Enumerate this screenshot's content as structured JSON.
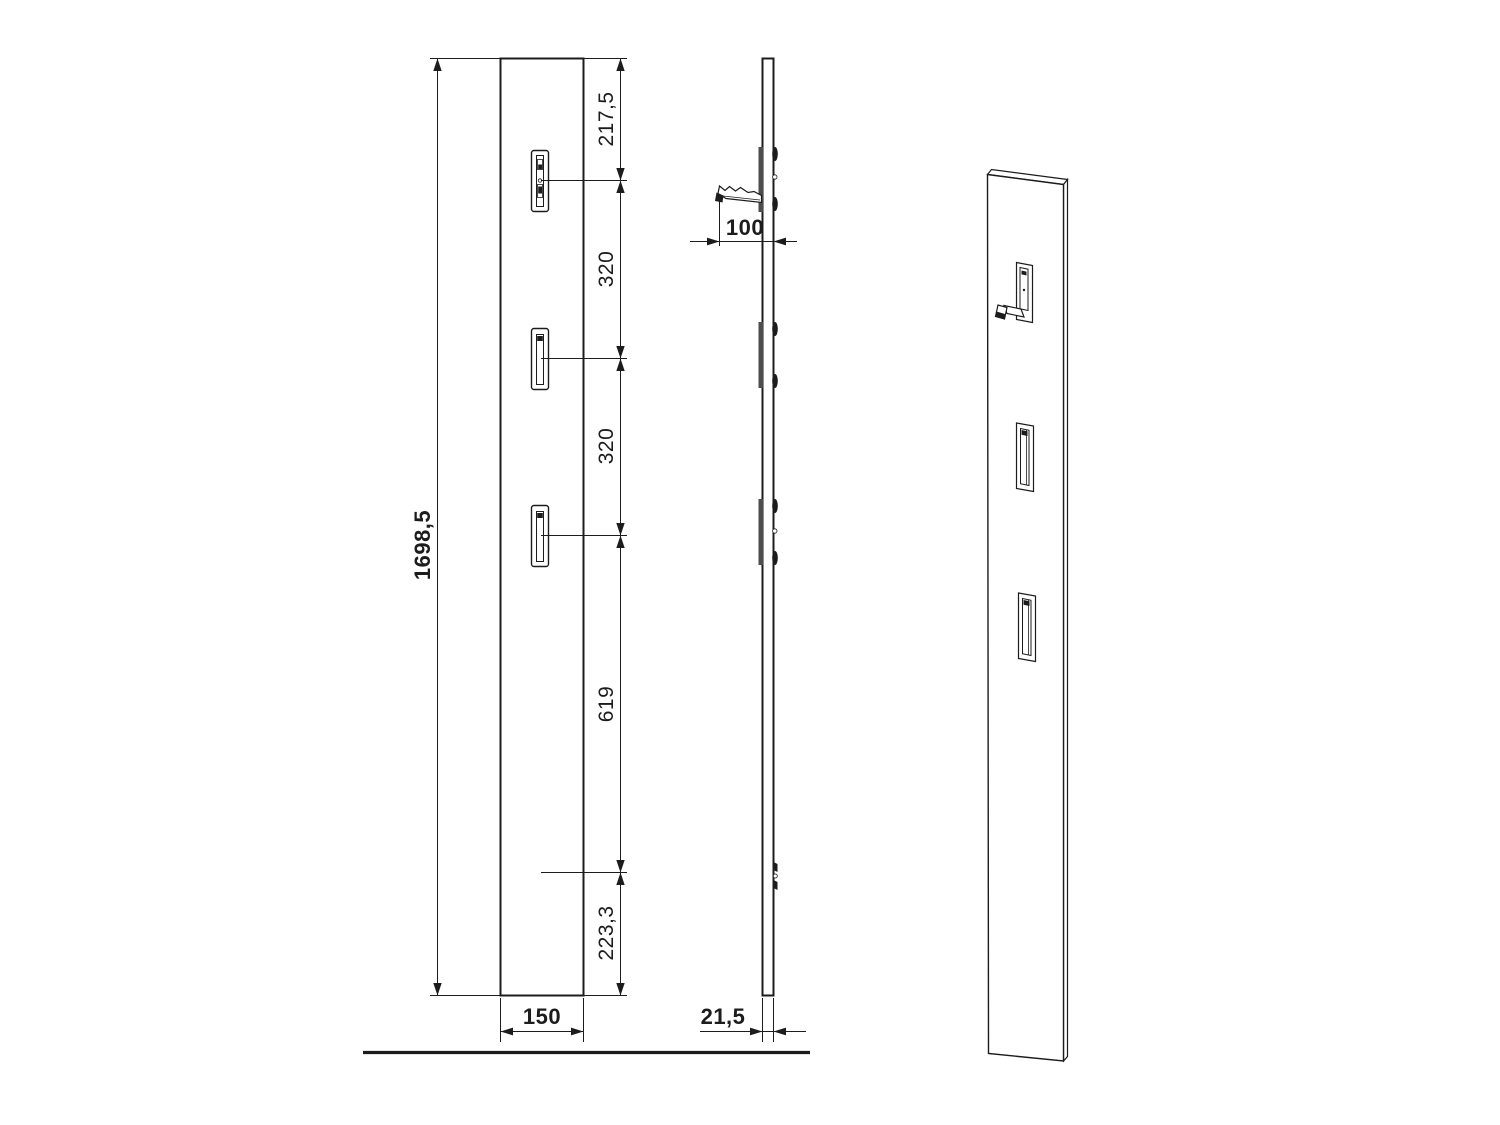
{
  "colors": {
    "ink": "#1c1c1c",
    "background": "#ffffff",
    "plate_gray": "#4d4d4d"
  },
  "front_view": {
    "total_height": "1698,5",
    "panel_width": "150",
    "segment_top_to_hook1": "217,5",
    "segment_hook1_to_hook2": "320",
    "segment_hook2_to_hook3": "320",
    "segment_hook3_to_mount": "619",
    "segment_mount_to_bottom": "223,3"
  },
  "side_view": {
    "hook_projection": "100",
    "panel_thickness": "21,5"
  }
}
